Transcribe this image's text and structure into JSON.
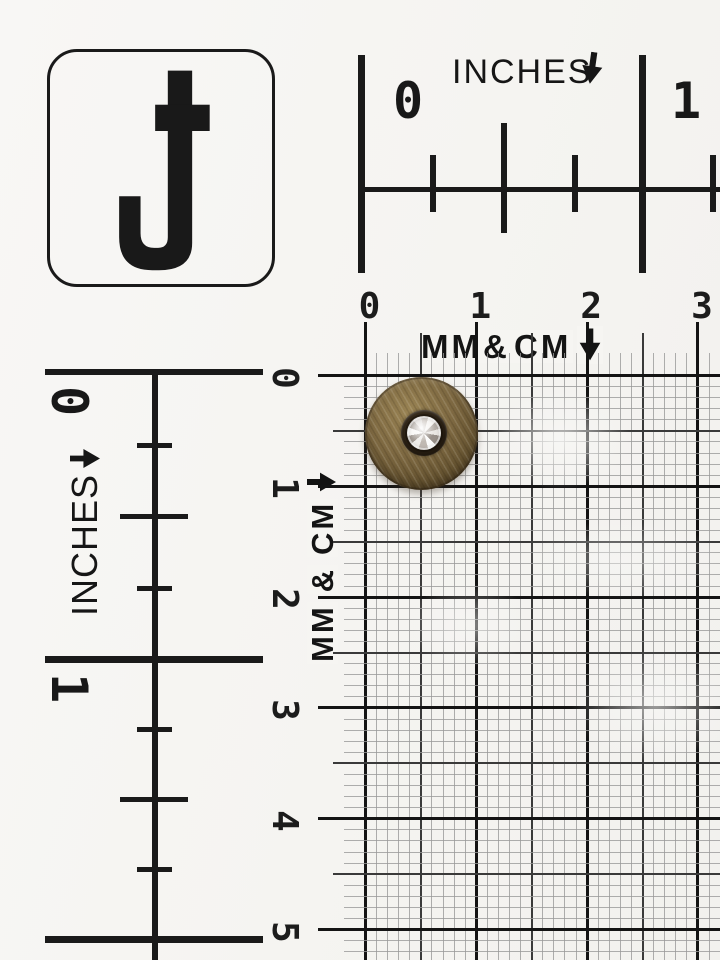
{
  "photo": {
    "subject": "antique-brass button with rhinestone center lying on a measuring grid card",
    "logo_icon": "j-cross-monogram"
  },
  "rulers": {
    "top_inches": {
      "label": "INCHES",
      "arrow_icon": "down-arrow",
      "numbers": [
        "0",
        "1"
      ]
    },
    "left_inches": {
      "label": "INCHES",
      "arrow_icon": "down-arrow-rotated-right",
      "numbers": [
        "0",
        "1"
      ]
    },
    "top_cm": {
      "label_mm": "MM",
      "label_amp": "&",
      "label_cm": "CM",
      "arrow_icon": "down-arrow",
      "numbers": [
        "0",
        "1",
        "2",
        "3"
      ]
    },
    "left_cm": {
      "label_mm": "MM",
      "label_amp": "&",
      "label_cm": "CM",
      "arrow_icon": "right-arrow",
      "numbers": [
        "0",
        "1",
        "2",
        "3",
        "4",
        "5"
      ]
    }
  },
  "colors": {
    "paper": "#f6f5f2",
    "ink": "#1a1a1a",
    "grid_mm": "#9a9a9a",
    "grid_half": "#3a3a3a",
    "grid_cm": "#141414",
    "brass_light": "#9a8454",
    "brass_mid": "#7d6841",
    "brass_dark": "#3c2f1b",
    "bezel": "#241b10",
    "crystal": "#e9e6e2"
  }
}
